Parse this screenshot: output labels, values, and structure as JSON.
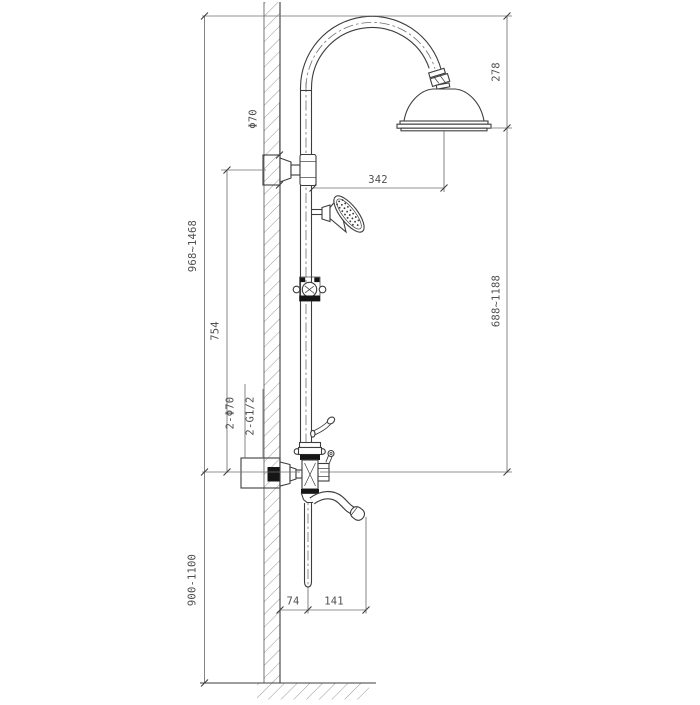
{
  "drawing": {
    "description": "Technical installation drawing of an exposed shower column with gooseneck rain head, hand shower, diverter mixer valve and curved tub spout, mounted on a hatched wall section above a hatched floor line",
    "dims": {
      "column_height": "968~1468",
      "bracket_to_valve": "754",
      "head_to_valve": "688~1188",
      "head_drop": "278",
      "head_reach": "342",
      "valve_to_floor": "900-1100",
      "flange_dia": "Φ70",
      "inlet_escutcheons": "2-Φ70",
      "inlet_threads": "2-G1/2",
      "wall_to_spout_pipe": "74",
      "pipe_to_spout_outlet": "141"
    },
    "colors": {
      "background": "#ffffff",
      "line": "#3d3d3d",
      "dim": "#6f6f6f",
      "text": "#4f4f4f",
      "black_fill": "#161616",
      "hatch": "#8c8c8c"
    }
  }
}
